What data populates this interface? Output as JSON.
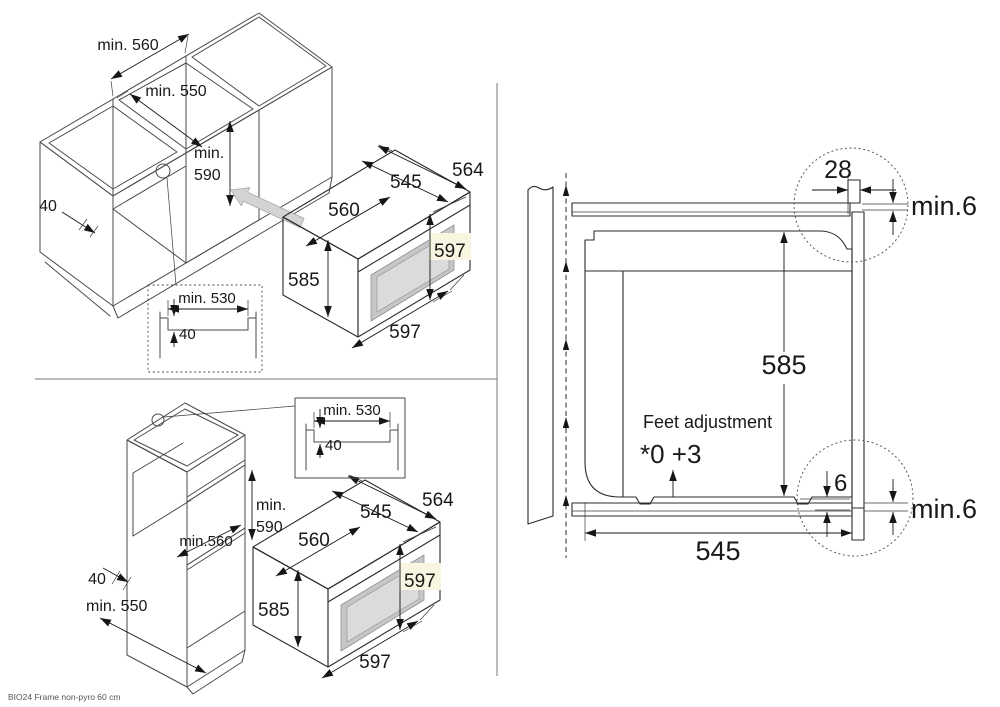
{
  "caption": "BIO24 Frame non-pyro 60 cm",
  "colors": {
    "line": "#2b2b2b",
    "oven_gray": "#aeaeae",
    "oven_top_gray": "#b7b7b7",
    "oven_door_gray": "#a1a1a1",
    "window_gray": "#dbdbdb",
    "arrow_gray": "#d4d4d4",
    "highlight": "#f8f5e0"
  },
  "oven": {
    "dim_depth_total": "564",
    "dim_depth_body": "545",
    "dim_width": "560",
    "dim_height_body": "585",
    "dim_height_front": "597",
    "dim_width_front": "597"
  },
  "figure_top_left": {
    "dim_opening_width": "min. 560",
    "dim_opening_depth": "min. 550",
    "dim_opening_height_line1": "min.",
    "dim_opening_height_line2": "590",
    "dim_plinth": "40",
    "inset": {
      "dim_width": "min. 530",
      "dim_depth": "40"
    }
  },
  "figure_bottom_left": {
    "dim_opening_height_line1": "min.",
    "dim_opening_height_line2": "590",
    "dim_opening_width": "min.560",
    "dim_gap": "40",
    "dim_opening_depth": "min. 550",
    "inset": {
      "dim_width": "min. 530",
      "dim_depth": "40"
    }
  },
  "figure_right": {
    "dim_frame_overlap": "28",
    "dim_top_clearance": "min.6",
    "dim_body_height": "585",
    "feet_note_line1": "Feet adjustment",
    "feet_note_line2": "*0 +3",
    "dim_foot_height": "6",
    "dim_bottom_clearance": "min.6",
    "dim_body_depth": "545"
  }
}
